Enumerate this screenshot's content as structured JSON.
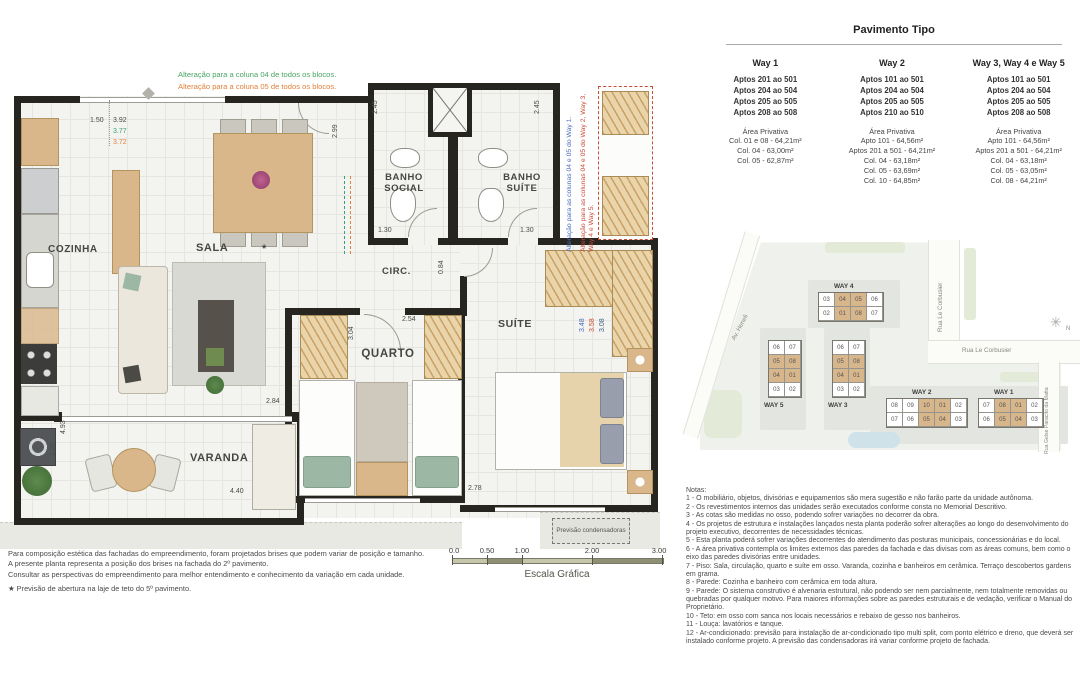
{
  "plan": {
    "rooms": {
      "cozinha": "COZINHA",
      "sala": "SALA",
      "banho_social": "BANHO SOCIAL",
      "banho_suite": "BANHO SUÍTE",
      "circ": "CIRC.",
      "quarto": "QUARTO",
      "suite": "SUÍTE",
      "varanda": "VARANDA"
    },
    "star": "*",
    "condensadoras": "Previsão condensadoras",
    "annotations": {
      "green": "Alteração para a coluna 04 de todos os blocos.",
      "orange": "Alteração para a coluna 05 de todos os blocos.",
      "blue_vertical": "Alteração para as colunas 04 e 05 do Way 1.",
      "red_vertical": "Alteração para as colunas 04 e 05 do Way 2, Way 3, Way 4 e Way 5."
    },
    "dims": {
      "d150": "1.50",
      "d392": "3.92",
      "d377": "3.77",
      "d372": "3.72",
      "d245": "2.45",
      "d299": "2.99",
      "d130": "1.30",
      "d084": "0.84",
      "d304": "3.04",
      "d254": "2.54",
      "d348": "3.48",
      "d358": "3.58",
      "d308": "3.08",
      "d284": "2.84",
      "d493": "4.93",
      "d120": "1.20",
      "d440": "4.40",
      "d278": "2.78"
    }
  },
  "footer": {
    "lines": [
      "Para composição estética das fachadas do empreendimento, foram projetados brises que podem variar de posição e tamanho.",
      "A presente planta representa a posição dos brises na fachada do 2º pavimento.",
      "Consultar as perspectivas do empreendimento para melhor entendimento e conhecimento da variação em cada unidade."
    ],
    "star_note": "★ Previsão de abertura na laje de teto do 5º pavimento."
  },
  "scale": {
    "ticks": [
      "0.0",
      "0.50",
      "1.00",
      "2.00",
      "3.00"
    ],
    "label": "Escala Gráfica"
  },
  "pavimento": {
    "title": "Pavimento Tipo",
    "columns": [
      {
        "label": "Way 1",
        "aptos": [
          "Aptos 201 ao 501",
          "Aptos 204 ao 504",
          "Aptos 205 ao 505",
          "Aptos 208 ao 508"
        ],
        "area_title": "Área Privativa",
        "areas": [
          "Col. 01 e 08 - 64,21m²",
          "Col. 04 - 63,00m²",
          "Col. 05 - 62,87m²"
        ]
      },
      {
        "label": "Way 2",
        "aptos": [
          "Aptos 101 ao 501",
          "Aptos 204 ao 504",
          "Aptos 205 ao 505",
          "Aptos 210 ao 510"
        ],
        "area_title": "Área Privativa",
        "areas": [
          "Apto 101 - 64,56m²",
          "Aptos 201 a 501 - 64,21m²",
          "Col. 04 - 63,18m²",
          "Col. 05 - 63,69m²",
          "Col. 10 - 64,85m²"
        ]
      },
      {
        "label": "Way 3, Way 4 e Way 5",
        "aptos": [
          "Aptos 101 ao 501",
          "Aptos 204 ao 504",
          "Aptos 205 ao 505",
          "Aptos 208 ao 508"
        ],
        "area_title": "Área Privativa",
        "areas": [
          "Apto 101 - 64,56m²",
          "Aptos 201 a 501 - 64,21m²",
          "Col. 04 - 63,18m²",
          "Col. 05 - 63,05m²",
          "Col. 08 - 64,21m²"
        ]
      }
    ]
  },
  "sitemap": {
    "streets": {
      "av": "Av. Heneli",
      "rua_v": "Rua Le Corbusier",
      "rua_h": "Rua Le Corbusier",
      "rua_right": "Rua Gelse Paracito da Matta"
    },
    "compass_icon": "✳",
    "north": "N",
    "buildings": [
      {
        "label": "WAY 4",
        "rows": [
          [
            "03",
            "04",
            "05",
            "06"
          ],
          [
            "02",
            "01",
            "08",
            "07"
          ]
        ],
        "highlight": [
          "04",
          "05",
          "01",
          "08"
        ]
      },
      {
        "label": "WAY 5",
        "rows": [
          [
            "06",
            "07"
          ],
          [
            "05",
            "08"
          ],
          [
            "04",
            "01"
          ],
          [
            "03",
            "02"
          ]
        ],
        "highlight": [
          "05",
          "08",
          "04",
          "01"
        ]
      },
      {
        "label": "WAY 3",
        "rows": [
          [
            "06",
            "07"
          ],
          [
            "05",
            "08"
          ],
          [
            "04",
            "01"
          ],
          [
            "03",
            "02"
          ]
        ],
        "highlight": [
          "05",
          "08",
          "04",
          "01"
        ]
      },
      {
        "label": "WAY 2",
        "rows": [
          [
            "08",
            "09",
            "10",
            "01",
            "02"
          ],
          [
            "07",
            "06",
            "05",
            "04",
            "03"
          ]
        ],
        "highlight": [
          "10",
          "01",
          "05",
          "04"
        ]
      },
      {
        "label": "WAY 1",
        "rows": [
          [
            "07",
            "08",
            "01",
            "02"
          ],
          [
            "06",
            "05",
            "04",
            "03"
          ]
        ],
        "highlight": [
          "08",
          "01",
          "05",
          "04"
        ]
      }
    ]
  },
  "notes": {
    "title": "Notas:",
    "items": [
      "1 - O mobiliário, objetos, divisórias e equipamentos são mera sugestão e não farão parte da unidade autônoma.",
      "2 - Os revestimentos internos das unidades serão executados conforme consta no Memorial Descritivo.",
      "3 - As cotas são medidas no osso, podendo sofrer variações no decorrer da obra.",
      "4 - Os projetos de estrutura e instalações lançados nesta planta poderão sofrer alterações ao longo do desenvolvimento do projeto executivo, decorrentes de necessidades técnicas.",
      "5 - Esta planta poderá sofrer variações decorrentes do atendimento das posturas municipais, concessionárias e do local.",
      "6 - A área privativa contempla os limites externos das paredes da fachada e das divisas com as áreas comuns, bem como o eixo das paredes divisórias entre unidades.",
      "7 - Piso: Sala, circulação, quarto e suíte em osso. Varanda, cozinha e banheiros em cerâmica. Terraço descobertos gardens em grama.",
      "8 - Parede: Cozinha e banheiro com cerâmica em toda altura.",
      "9 - Parede: O sistema construtivo é alvenaria estrutural, não podendo ser nem parcialmente, nem totalmente removidas ou quebradas por qualquer motivo. Para maiores informações sobre as paredes estruturais e de vedação, verificar o Manual do Proprietário.",
      "10 - Teto: em osso com sanca nos locais necessários e rebaixo de gesso nos banheiros.",
      "11 - Louça: lavatórios e tanque.",
      "12 - Ar-condicionado: previsão para instalação de ar-condicionado tipo multi split, com ponto elétrico e dreno, que deverá ser instalado conforme projeto. A previsão das condensadoras irá variar conforme projeto de fachada."
    ]
  }
}
